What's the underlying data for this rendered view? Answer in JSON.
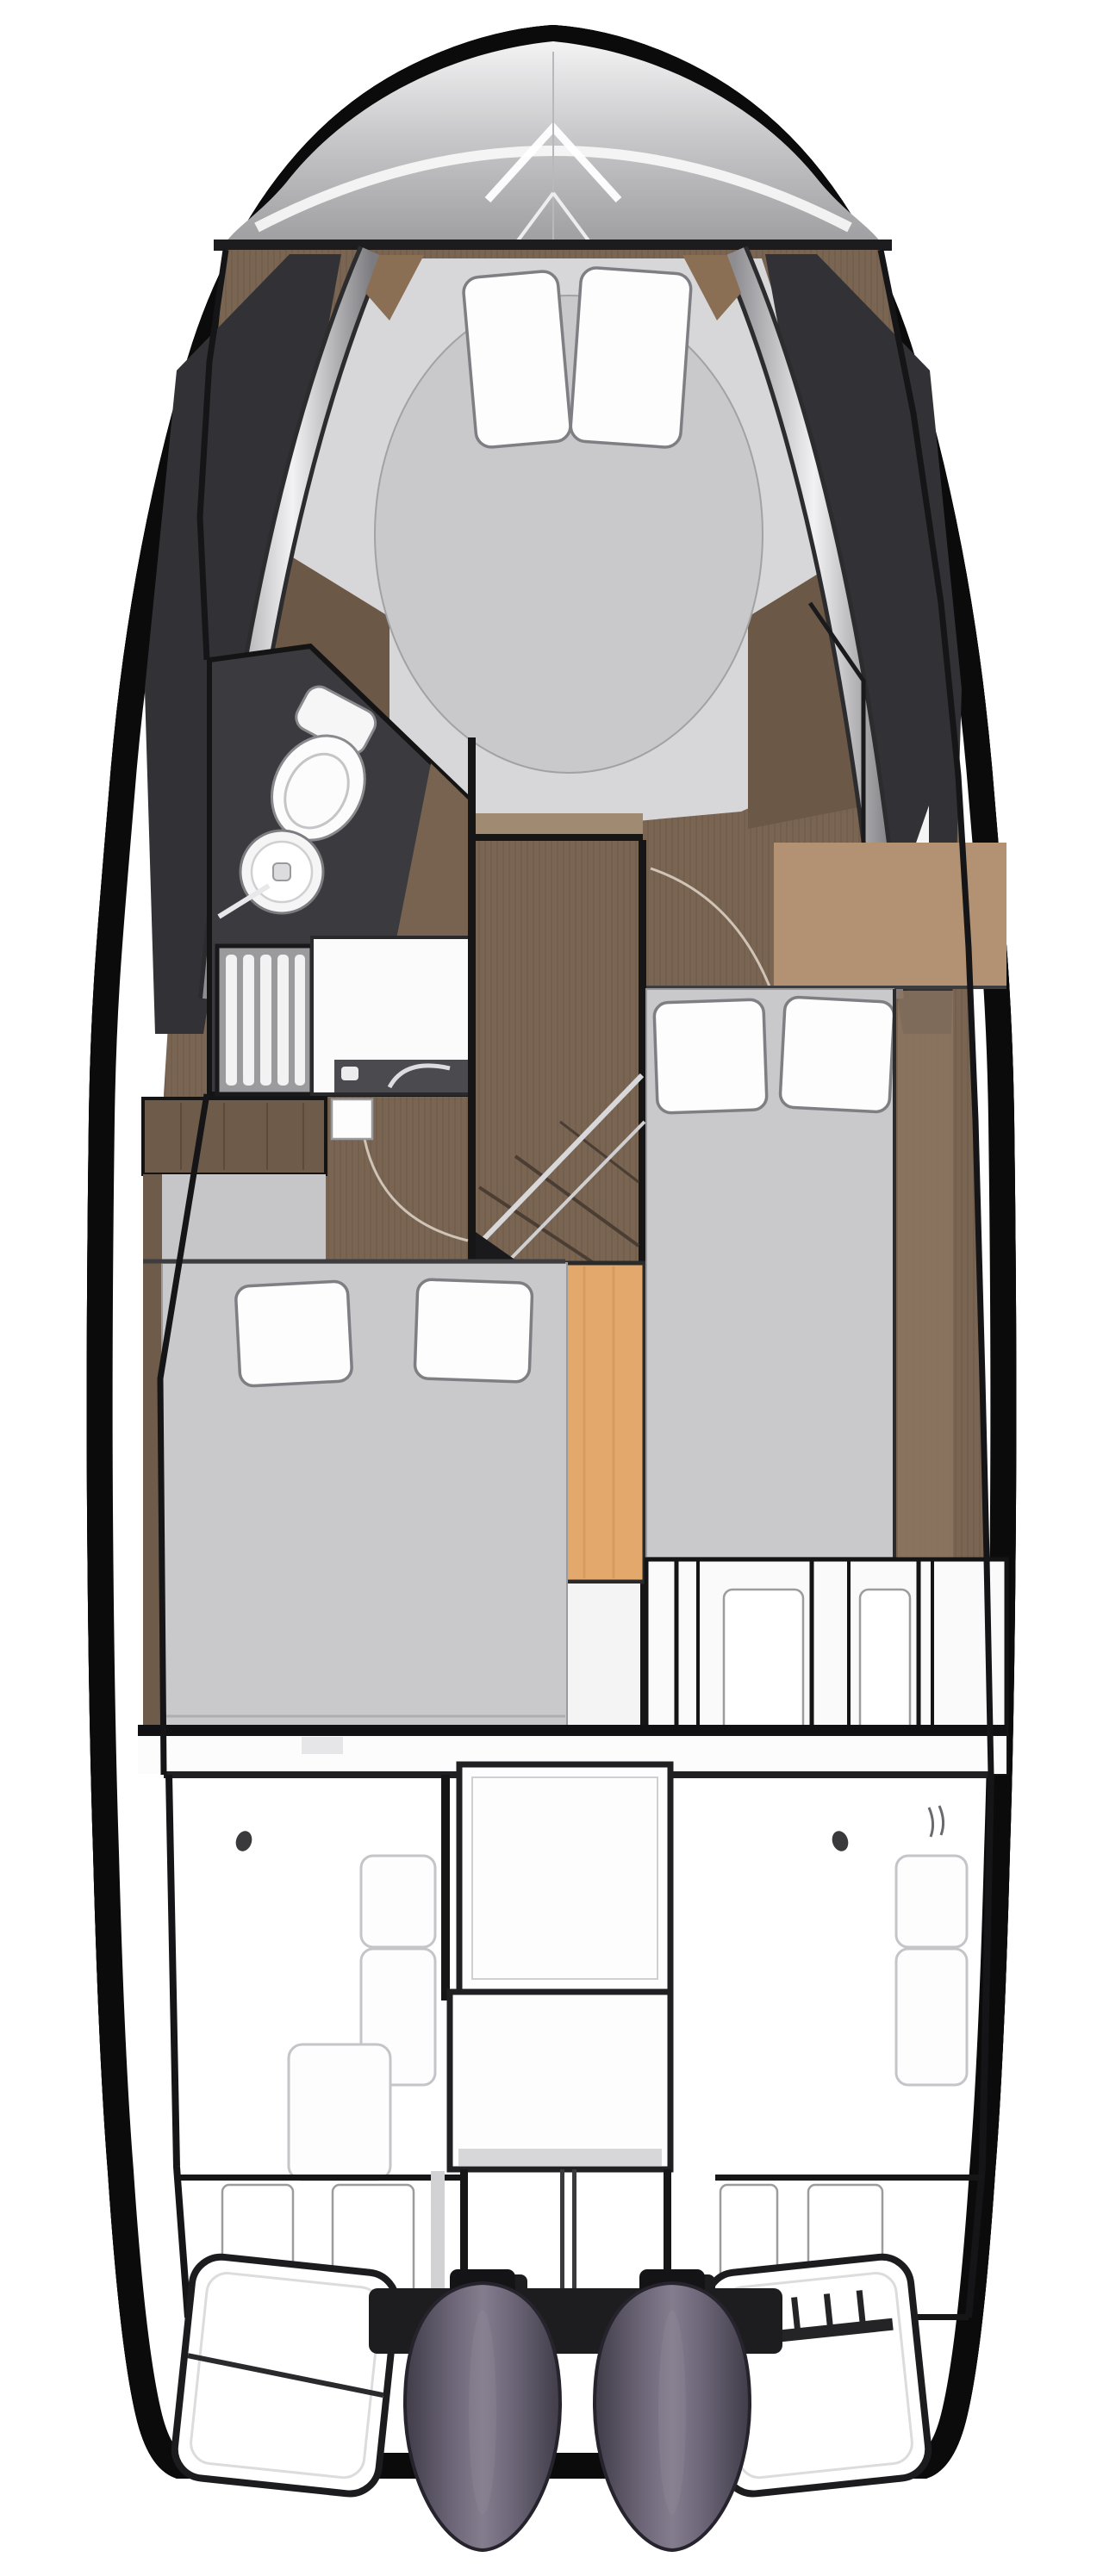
{
  "meta": {
    "kind": "yacht-floor-plan",
    "view": "top-down deck / accommodation plan",
    "orientation": "bow at top, stern with twin outboard engines at bottom",
    "text_on_image": "none"
  },
  "colors": {
    "background": "#ffffff",
    "hull_line": "#0b0b0c",
    "chrome_band": "#d9d9db",
    "chrome_core": "#4a4a4e",
    "bow_deck_light": "#efefef",
    "bow_deck_dark": "#9d9da0",
    "wood": "#7a6553",
    "wood_dark": "#6c5846",
    "wood_light": "#a08a72",
    "charcoal_floor": "#3b3a3e",
    "cabin_gray": "#d7d7d9",
    "floor_gray": "#c6c6c8",
    "mattress": "#c9c9cc",
    "pillow": "#fdfdfe",
    "orange_steps": "#e3a96c",
    "tan_desk": "#b29272",
    "white_fixture": "#fbfbfc",
    "counter_dark": "#4b4a4f",
    "engine_body": "#5f5a68",
    "engine_edge": "#413c48",
    "transom": "#1d1d20",
    "cockpit_line": "#161616"
  },
  "regions": {
    "bow_deck": {
      "name": "foredeck sun pad with anchor hatch",
      "hatch": "V outline"
    },
    "v_berth": {
      "name": "forward owner cabin",
      "bed": "island oval double bed",
      "pillow_count": 2
    },
    "bathroom": {
      "name": "heads / wet room (port side)",
      "fixtures": [
        "toilet",
        "round washbasin",
        "shower grating",
        "vanity with dark counter and faucet"
      ]
    },
    "mid_cabin": {
      "name": "port midship guest cabin",
      "bed": "double bed",
      "pillow_count": 2
    },
    "aft_cabin": {
      "name": "starboard aft guest cabin",
      "bed": "double bed",
      "pillow_count": 2,
      "desk": "tan side unit"
    },
    "staircase": {
      "name": "companionway stairs",
      "handrails": 2,
      "step_block_color": "orange"
    },
    "galley_module": {
      "name": "aft white cabinet module with sliding panels",
      "panel_dividers": 6
    },
    "cockpit": {
      "name": "aft cockpit",
      "console_boxes": 2,
      "bench_cushions": 5,
      "locker_lids": 4,
      "deck_dots": 2
    },
    "stern": {
      "engines": 2,
      "swim_platforms": 2,
      "boarding_ladder": true,
      "transom_beam": true
    }
  }
}
